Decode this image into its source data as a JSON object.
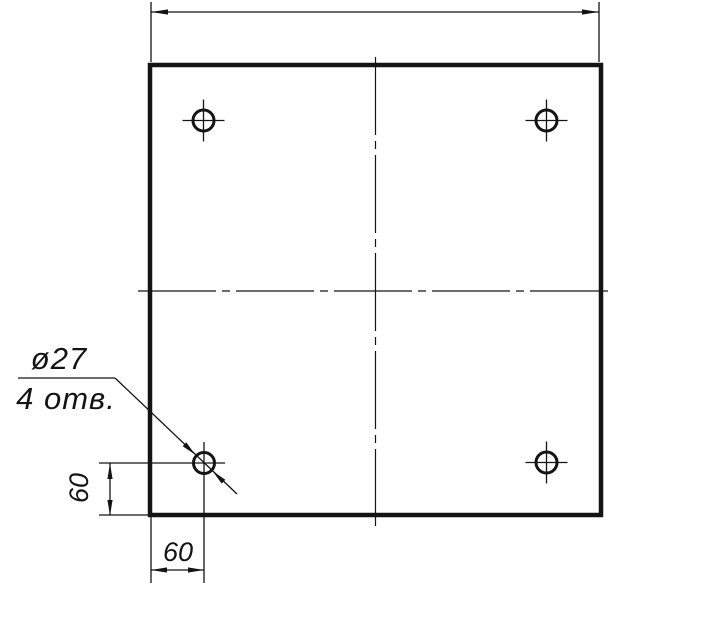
{
  "page": {
    "background": "#ffffff",
    "ink": "#141414"
  },
  "drawing": {
    "callout": {
      "diameter_label": "ø27",
      "count_label": "4 отв."
    },
    "dimensions": {
      "vertical_offset": "60",
      "horizontal_offset": "60"
    },
    "values": {
      "hole_diameter": 27,
      "hole_count": 4,
      "hole_edge_offset": 60
    }
  }
}
